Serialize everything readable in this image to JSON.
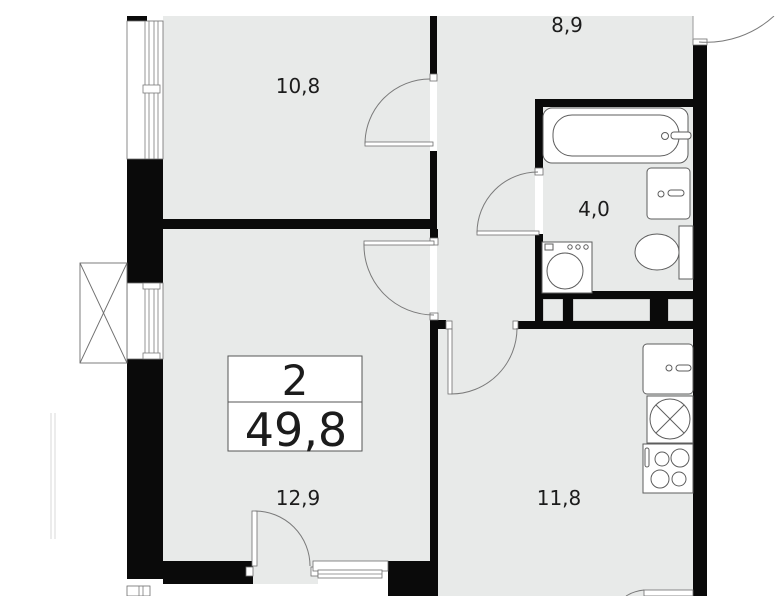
{
  "plan": {
    "type": "apartment-floor-plan",
    "summary": {
      "rooms_count": "2",
      "total_area": "49,8"
    },
    "rooms": [
      {
        "name": "bedroom",
        "area": "10,8"
      },
      {
        "name": "hallway",
        "area": "8,9"
      },
      {
        "name": "bathroom",
        "area": "4,0"
      },
      {
        "name": "living-room",
        "area": "12,9"
      },
      {
        "name": "kitchen",
        "area": "11,8"
      }
    ],
    "fixtures": [
      "bathtub",
      "wash-basin",
      "toilet",
      "washing-machine",
      "kitchen-sink",
      "hob-unit",
      "stove-4-burners",
      "ac-basket",
      "windows",
      "doors"
    ],
    "colors": {
      "floor": "#e8eae9",
      "wall": "#0a0a0a",
      "thin_line": "#6e6e6e",
      "background": "#ffffff",
      "text": "#1c1c1c"
    }
  }
}
